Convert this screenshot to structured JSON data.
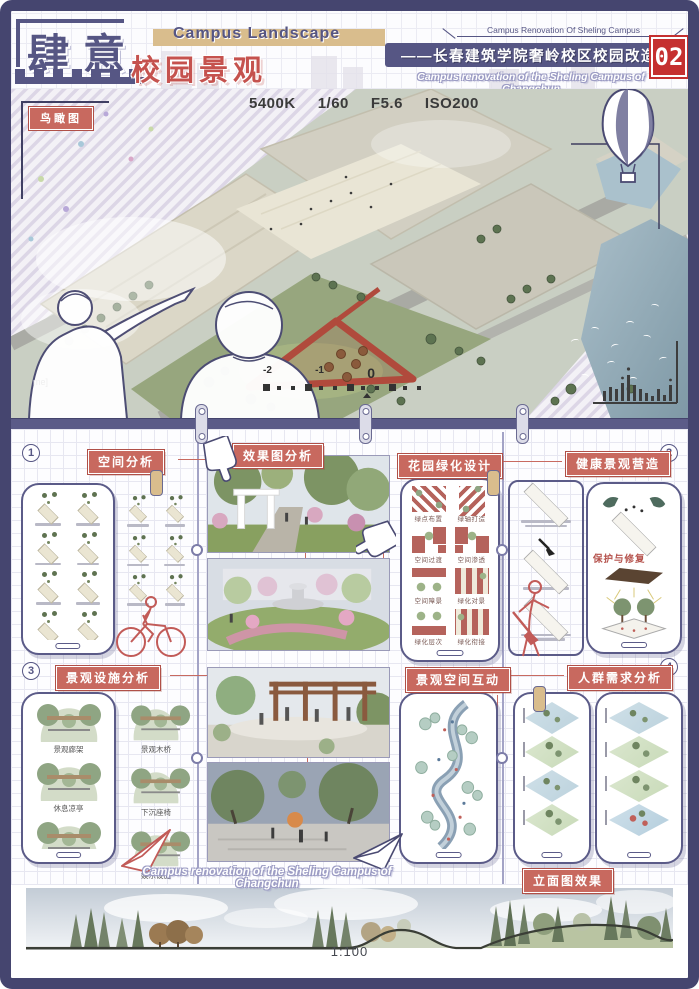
{
  "header": {
    "bracket_title": "肆意",
    "subtitle": "校园景观",
    "banner_en": "Campus Landscape",
    "project_en_small": "Campus Renovation Of Sheling Campus",
    "project_cn": "——长春建筑学院奢岭校区校园改造",
    "project_en": "Campus renovation of the Sheling Campus of Changchun",
    "page_number": "02"
  },
  "aerial": {
    "badge": "鸟瞰图",
    "camera": [
      "5400K",
      "1/60",
      "F5.6",
      "ISO200"
    ],
    "meter_labels": [
      "-2",
      "-1",
      "0"
    ],
    "frame_text": "me]"
  },
  "sections": {
    "s1": {
      "num": "1",
      "title": "空间分析"
    },
    "render": {
      "title": "效果图分析"
    },
    "garden": {
      "title": "花园绿化设计",
      "items": [
        "绿点布置",
        "绿轴打造",
        "空间过渡",
        "空间渗透",
        "空间障景",
        "绿化对景",
        "绿化层次",
        "绿化衔接"
      ]
    },
    "s2": {
      "num": "2",
      "title": "健康景观营造",
      "center_label": "保护与修复"
    },
    "s3": {
      "num": "3",
      "title": "景观设施分析",
      "left_items": [
        "景观廊架",
        "休息凉亭",
        "景观树池"
      ],
      "right_items": [
        "景观木桥",
        "下沉座椅",
        "娱乐设施"
      ]
    },
    "interaction": {
      "title": "景观空间互动"
    },
    "s4": {
      "num": "4",
      "title": "人群需求分析"
    },
    "elevation": {
      "title": "立面图效果",
      "scale": "1:100"
    },
    "footer_en": "Campus renovation of the Sheling Campus of Changchun"
  },
  "colors": {
    "accent_purple": "#565684",
    "accent_red": "#c8695f",
    "tan": "#d9bd8d",
    "page_red": "#c53030",
    "frame_navy": "#45456f"
  }
}
